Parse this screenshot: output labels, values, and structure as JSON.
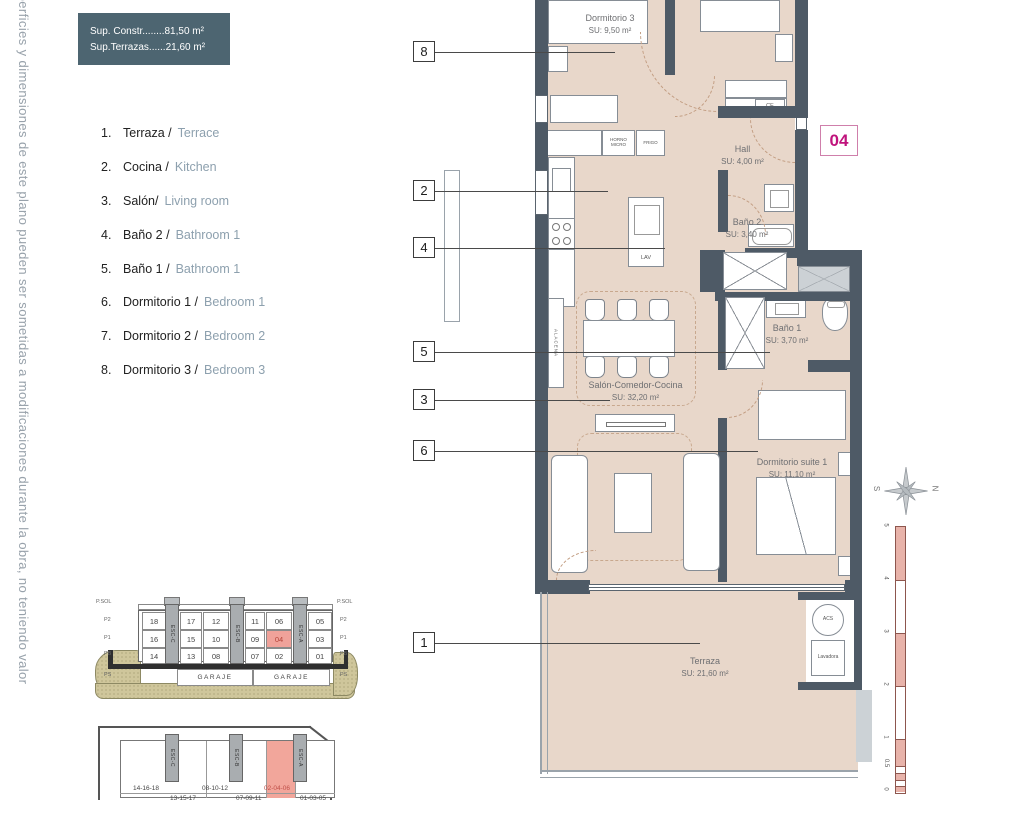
{
  "disclaimer": "uperficies y dimensiones de este plano pueden ser sometidas a modificaciones durante la obra, no teniendo valor",
  "info_box": {
    "line1": "Sup. Constr........81,50 m²",
    "line2": "Sup.Terrazas......21,60 m²"
  },
  "unit_badge": "04",
  "legend": {
    "items": [
      {
        "num": "1.",
        "es": "Terraza /",
        "en": "Terrace"
      },
      {
        "num": "2.",
        "es": "Cocina /",
        "en": "Kitchen"
      },
      {
        "num": "3.",
        "es": "Salón/",
        "en": "Living room"
      },
      {
        "num": "4.",
        "es": "Baño 2 /",
        "en": "Bathroom 1"
      },
      {
        "num": "5.",
        "es": "Baño 1 /",
        "en": "Bathroom 1"
      },
      {
        "num": "6.",
        "es": "Dormitorio 1 /",
        "en": "Bedroom 1"
      },
      {
        "num": "7.",
        "es": "Dormitorio 2 /",
        "en": "Bedroom 2"
      },
      {
        "num": "8.",
        "es": "Dormitorio 3 /",
        "en": "Bedroom 3"
      }
    ]
  },
  "plan": {
    "rooms": {
      "dormitorio3": {
        "name": "Dormitorio 3",
        "area": "SU: 9,50 m²"
      },
      "hall": {
        "name": "Hall",
        "area": "SU: 4,00 m²"
      },
      "bano2": {
        "name": "Baño 2",
        "area": "SU: 3,40 m²"
      },
      "bano1": {
        "name": "Baño 1",
        "area": "SU: 3,70 m²"
      },
      "salon": {
        "name": "Salón-Comedor-Cocina",
        "area": "SU: 32,20 m²"
      },
      "suite": {
        "name": "Dormitorio suite 1",
        "area": "SU: 11,10 m²"
      },
      "terraza": {
        "name": "Terraza",
        "area": "SU: 21,60 m²"
      }
    },
    "fixtures": {
      "horno": "HORNO MICRO",
      "frigo": "FRIGO",
      "lav": "LAV",
      "alacena": "ALACENA",
      "ce": "CE",
      "acs": "ACS",
      "lavadora": "Lavadora"
    },
    "callouts": [
      "8",
      "2",
      "4",
      "5",
      "3",
      "6",
      "1"
    ]
  },
  "compass": {
    "west": "S",
    "east": "N"
  },
  "scale": {
    "labels": [
      "5",
      "4",
      "3",
      "2",
      "1",
      "0.5",
      "0"
    ]
  },
  "section": {
    "left_labels": [
      "P.SOL",
      "P2",
      "P1",
      "PB",
      "PS"
    ],
    "right_labels": [
      "P.SOL",
      "P2",
      "P1",
      "PB",
      "PS"
    ],
    "p2": [
      "18",
      "17",
      "12",
      "11",
      "06",
      "05"
    ],
    "p1": [
      "16",
      "15",
      "10",
      "09",
      "04",
      "03"
    ],
    "pb": [
      "14",
      "13",
      "08",
      "07",
      "02",
      "01"
    ],
    "garage": [
      "GARAJE",
      "GARAJE"
    ],
    "stairs": [
      "ESC-C",
      "ESC-B",
      "ESC-A"
    ]
  },
  "block": {
    "stairs": [
      "ESC-C",
      "ESC-B",
      "ESC-A"
    ],
    "row1": [
      "14-16-18",
      "08-10-12",
      "02-04-06"
    ],
    "row2": [
      "13-15-17",
      "07-09-11",
      "01-03-05"
    ]
  }
}
